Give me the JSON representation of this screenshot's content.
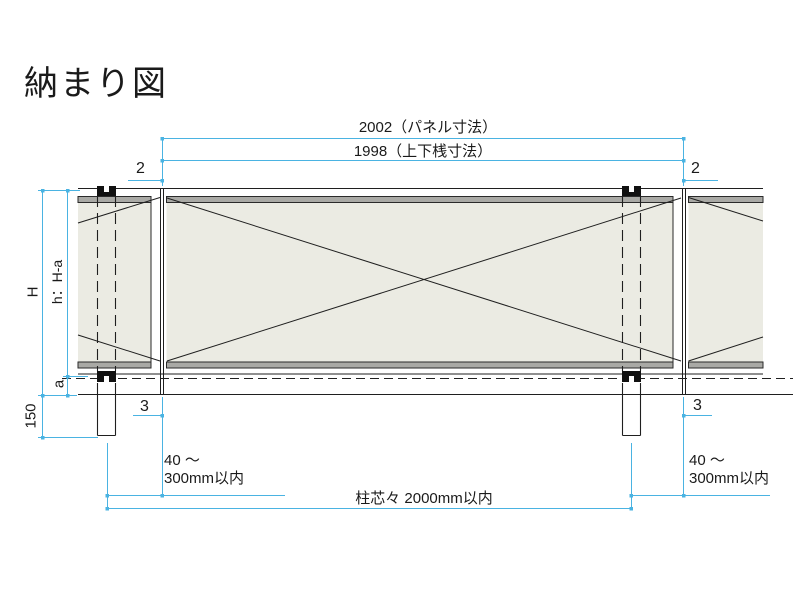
{
  "title": "納まり図",
  "colors": {
    "dimension_line": "#4ab3e2",
    "drawing_line": "#1f1f1f",
    "panel_fill": "#ebebe3",
    "rail_band_fill": "#a9a9a5"
  },
  "dims": {
    "panel_width": "2002（パネル寸法）",
    "rail_width": "1998（上下桟寸法）",
    "top_gap_left": "2",
    "top_gap_right": "2",
    "bottom_gap_left": "3",
    "bottom_gap_right": "3",
    "overall_height": "H",
    "panel_height": "h：H-a",
    "ground_clearance": "a",
    "embedment": "150",
    "offset_left_line1": "40 ～",
    "offset_left_line2": "300mm以内",
    "offset_right_line1": "40 ～",
    "offset_right_line2": "300mm以内",
    "post_spacing": "柱芯々 2000mm以内"
  }
}
